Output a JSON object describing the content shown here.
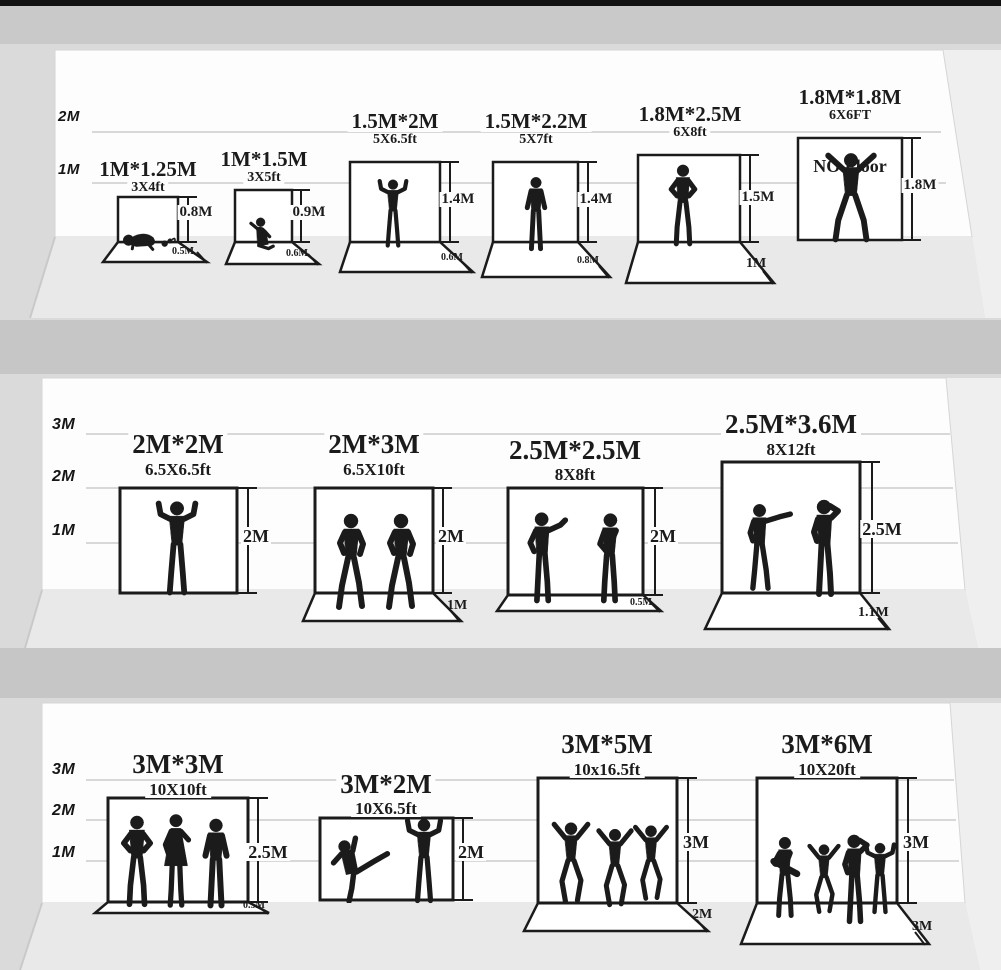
{
  "colors": {
    "background": "#dadada",
    "top_bar": "#121212",
    "shelf_band": "#c6c6c6",
    "wall": "#fdfdfd",
    "floor": "#e9e9e9",
    "ink": "#1b1b1b",
    "gridline": "#cccccc"
  },
  "sections": [
    {
      "axis_labels": [
        "2M",
        "1M"
      ],
      "backdrops": [
        {
          "title": "1M*1.25M",
          "subtitle": "3X4ft",
          "height_label": "0.8M",
          "floor_label": "0.5M",
          "figures": [
            "crawling-baby",
            "pet-toy"
          ]
        },
        {
          "title": "1M*1.5M",
          "subtitle": "3X5ft",
          "height_label": "0.9M",
          "floor_label": "0.6M",
          "figures": [
            "toddler-girl"
          ]
        },
        {
          "title": "1.5M*2M",
          "subtitle": "5X6.5ft",
          "height_label": "1.4M",
          "floor_label": "0.6M",
          "figures": [
            "child-arms-raised"
          ]
        },
        {
          "title": "1.5M*2.2M",
          "subtitle": "5X7ft",
          "height_label": "1.4M",
          "floor_label": "0.8M",
          "figures": [
            "child-standing"
          ]
        },
        {
          "title": "1.8M*2.5M",
          "subtitle": "6X8ft",
          "height_label": "1.5M",
          "floor_label": "1M",
          "figures": [
            "man-hands-on-hips"
          ]
        },
        {
          "title": "1.8M*1.8M",
          "subtitle": "6X6FT",
          "height_label": "1.8M",
          "floor_label": null,
          "note": "NO Floor",
          "figures": [
            "man-arms-spread"
          ]
        }
      ]
    },
    {
      "axis_labels": [
        "3M",
        "2M",
        "1M"
      ],
      "backdrops": [
        {
          "title": "2M*2M",
          "subtitle": "6.5X6.5ft",
          "height_label": "2M",
          "floor_label": null,
          "figures": [
            "man-victory-pose"
          ]
        },
        {
          "title": "2M*3M",
          "subtitle": "6.5X10ft",
          "height_label": "2M",
          "floor_label": "1M",
          "figures": [
            "walking-man",
            "walking-man"
          ]
        },
        {
          "title": "2.5M*2.5M",
          "subtitle": "8X8ft",
          "height_label": "2M",
          "floor_label": "0.5M",
          "figures": [
            "man-gesturing",
            "man-listening"
          ]
        },
        {
          "title": "2.5M*3.6M",
          "subtitle": "8X12ft",
          "height_label": "2.5M",
          "floor_label": "1.1M",
          "figures": [
            "man-pointing",
            "man-on-phone"
          ]
        }
      ]
    },
    {
      "axis_labels": [
        "3M",
        "2M",
        "1M"
      ],
      "backdrops": [
        {
          "title": "3M*3M",
          "subtitle": "10X10ft",
          "height_label": "2.5M",
          "floor_label": "0.5M",
          "figures": [
            "man-hands-on-hips",
            "woman-standing",
            "man-standing"
          ]
        },
        {
          "title": "3M*2M",
          "subtitle": "10X6.5ft",
          "height_label": "2M",
          "floor_label": null,
          "figures": [
            "man-kicking",
            "man-dancing"
          ]
        },
        {
          "title": "3M*5M",
          "subtitle": "10x16.5ft",
          "height_label": "3M",
          "floor_label": "2M",
          "figures": [
            "dancer",
            "dancer",
            "dancer"
          ]
        },
        {
          "title": "3M*6M",
          "subtitle": "10X20ft",
          "height_label": "3M",
          "floor_label": "3M",
          "figures": [
            "guitarist",
            "dancer",
            "singer",
            "dancer"
          ]
        }
      ]
    }
  ]
}
